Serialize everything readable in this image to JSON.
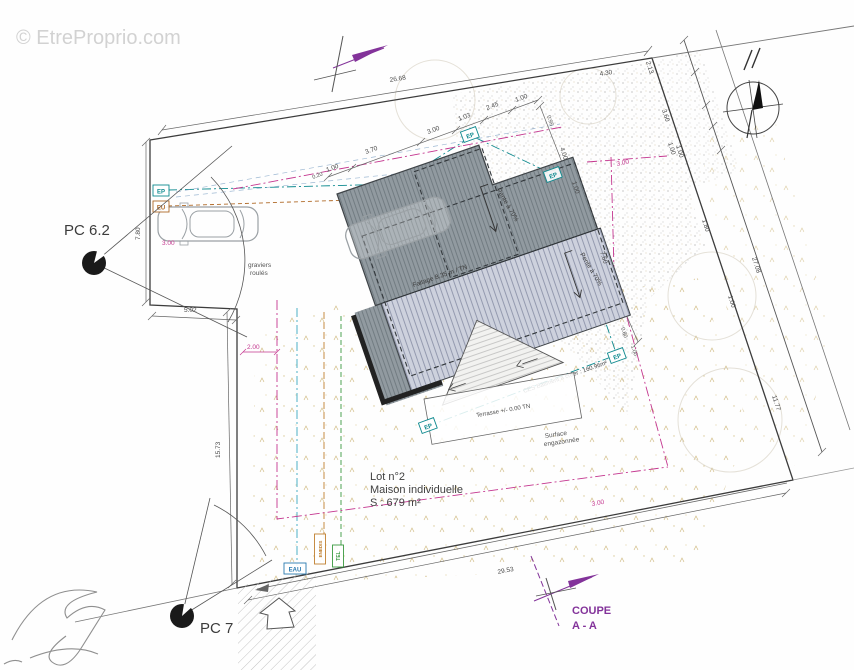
{
  "watermark": "© EtreProprio.com",
  "labels": {
    "pc62": "PC 6.2",
    "pc7": "PC 7",
    "graviers_1": "graviers",
    "graviers_2": "roulés",
    "lot_line1": "Lot n°2",
    "lot_line2": "Maison individuelle",
    "lot_line3": "S : 679 m²",
    "surface_1": "Surface",
    "surface_2": "engazonnée",
    "terrasse": "Terrasse +/- 0.00 TN",
    "ces": "CES Bâtiment à créer : 160.96m²",
    "faitage": "Faitage 8.35 m / TN",
    "pente1": "Pente à 70%",
    "pente2": "Pente à 70%",
    "coupe_1": "COUPE",
    "coupe_2": "A - A"
  },
  "utility_tags": {
    "ep": "EP",
    "eu": "EU",
    "eau": "EAU",
    "enedis": "ENEDIS",
    "tel": "TEL"
  },
  "dimensions": {
    "d2668": "26.68",
    "d430": "4.30",
    "d213": "2.13",
    "d360": "3.60",
    "d100": "1.00",
    "d180": "1.80",
    "d2708": "27.08",
    "d1177": "11.77",
    "d2953": "29.53",
    "d1573": "15.73",
    "d780": "7.80",
    "d502": "5.02",
    "d200": "2.00",
    "d300": "3.00",
    "d370": "3.70",
    "d020": "0.20",
    "d103": "1.03",
    "d245": "2.45",
    "d095": "0.95",
    "d400": "4.00",
    "d760": "7.60",
    "d080": "0.80"
  },
  "colors": {
    "magenta": "#c4368f",
    "teal": "#0e8a8f",
    "orange": "#b06a28",
    "green": "#3a9a40",
    "purple": "#83339a",
    "roof_dark": "#919aa0",
    "roof_light": "#cdd1dd"
  }
}
